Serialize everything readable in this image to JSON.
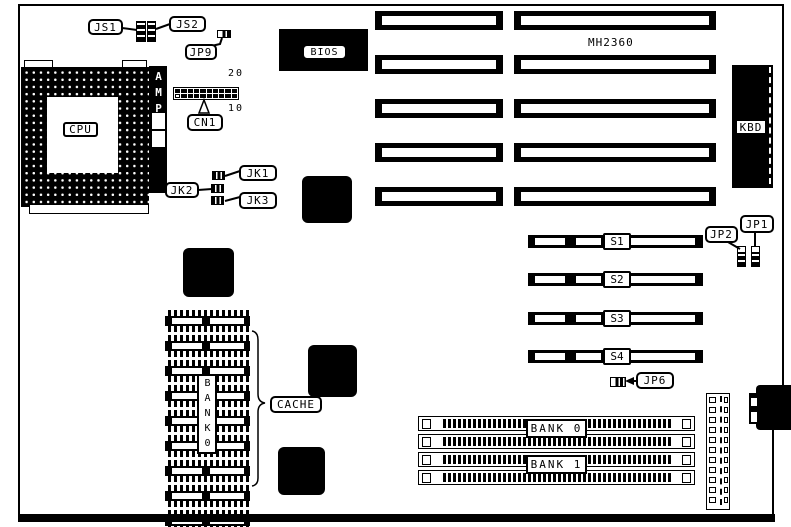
{
  "diagram": {
    "type": "motherboard-layout",
    "model": "MH2360",
    "colors": {
      "foreground": "#000000",
      "background": "#ffffff"
    },
    "cpu": {
      "label": "CPU",
      "bracket_label": "AMP"
    },
    "bios": {
      "label": "BIOS"
    },
    "keyboard_connector": {
      "label": "KBD"
    },
    "cn1": {
      "label": "CN1",
      "pin_top": "20",
      "pin_bottom": "10",
      "pin_count": 20
    },
    "jumpers": {
      "js1": "JS1",
      "js2": "JS2",
      "jp9": "JP9",
      "jk1": "JK1",
      "jk2": "JK2",
      "jk3": "JK3",
      "jp1": "JP1",
      "jp2": "JP2",
      "jp6": "JP6"
    },
    "cache": {
      "label": "CACHE",
      "bank_label": "BANK0",
      "chip_count": 9
    },
    "sipp_slots": {
      "labels": [
        "S1",
        "S2",
        "S3",
        "S4"
      ]
    },
    "simm_banks": {
      "bank0": "BANK 0",
      "bank1": "BANK 1",
      "slot_count": 4
    },
    "isa_slots": {
      "count": 5
    },
    "power_connector": {
      "pin_count": 11
    }
  }
}
